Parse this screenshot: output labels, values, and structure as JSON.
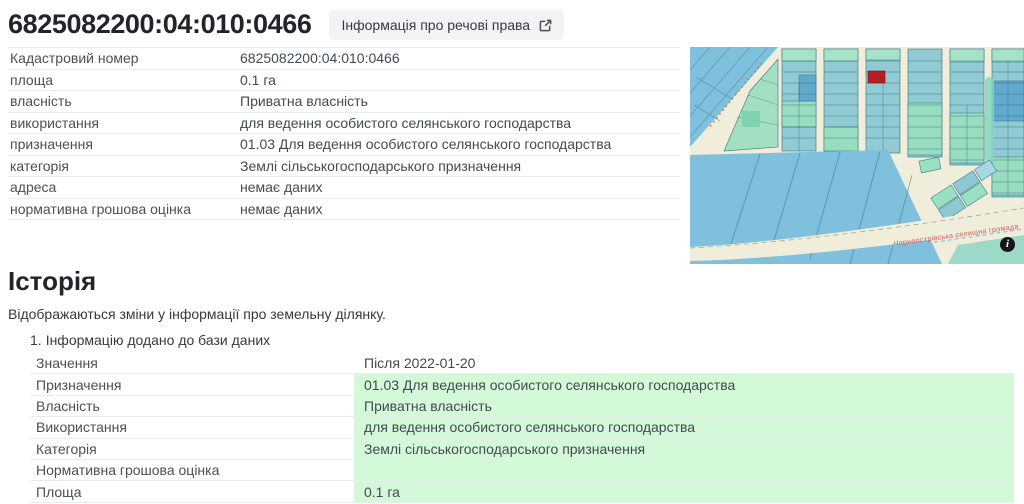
{
  "header": {
    "title": "6825082200:04:010:0466",
    "rights_button_label": "Інформація про речові права"
  },
  "parcel_info": {
    "rows": [
      {
        "label": "Кадастровий номер",
        "value": "6825082200:04:010:0466"
      },
      {
        "label": "площа",
        "value": "0.1 га"
      },
      {
        "label": "власність",
        "value": "Приватна власність"
      },
      {
        "label": "використання",
        "value": "для ведення особистого селянського господарства"
      },
      {
        "label": "призначення",
        "value": "01.03 Для ведення особистого селянського господарства"
      },
      {
        "label": "категорія",
        "value": "Землі сільськогосподарського призначення"
      },
      {
        "label": "адреса",
        "value": "немає даних"
      },
      {
        "label": "нормативна грошова оцінка",
        "value": "немає даних"
      }
    ]
  },
  "map": {
    "area_label": "Чорноострівська селищна громада",
    "highlight_color": "#b32025",
    "info_icon": "i"
  },
  "history": {
    "title": "Історія",
    "description": "Відображаються зміни у інформації про земельну ділянку.",
    "highlight_color": "#d3f9d8",
    "entries": [
      {
        "index": "1.",
        "title": "Інформацію додано до бази даних",
        "header": {
          "label": "Значення",
          "value": "Після 2022-01-20"
        },
        "rows": [
          {
            "label": "Призначення",
            "value": "01.03 Для ведення особистого селянського господарства"
          },
          {
            "label": "Власність",
            "value": "Приватна власність"
          },
          {
            "label": "Використання",
            "value": "для ведення особистого селянського господарства"
          },
          {
            "label": "Категорія",
            "value": "Землі сільськогосподарського призначення"
          },
          {
            "label": "Нормативна грошова оцінка",
            "value": ""
          },
          {
            "label": "Площа",
            "value": "0.1 га"
          }
        ]
      }
    ]
  }
}
